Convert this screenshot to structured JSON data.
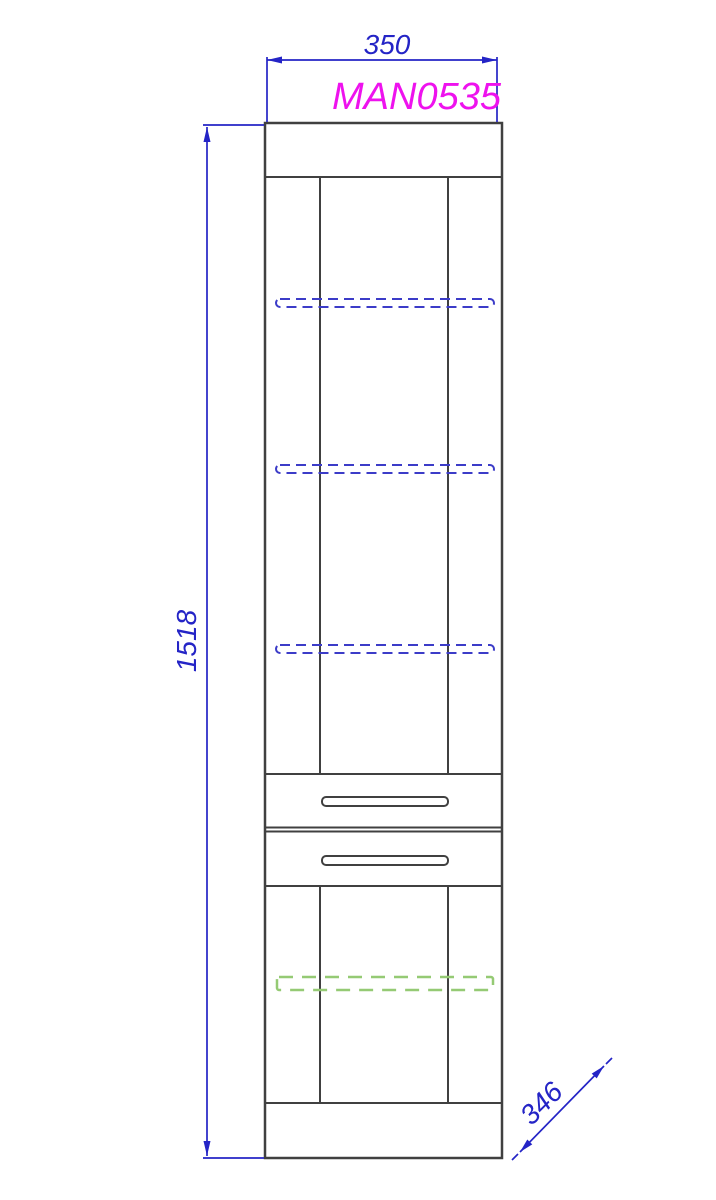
{
  "drawing": {
    "product_code": "MAN0535",
    "width_dimension": "350",
    "height_dimension": "1518",
    "depth_dimension": "346"
  },
  "colors": {
    "dimension_blue": "#2424c6",
    "product_code_magenta": "#ee12ee",
    "cabinet_line": "#404040",
    "hidden_shelf_blue": "#3c3cc8",
    "adjustable_shelf_green": "#95ca74",
    "background": "#ffffff"
  }
}
